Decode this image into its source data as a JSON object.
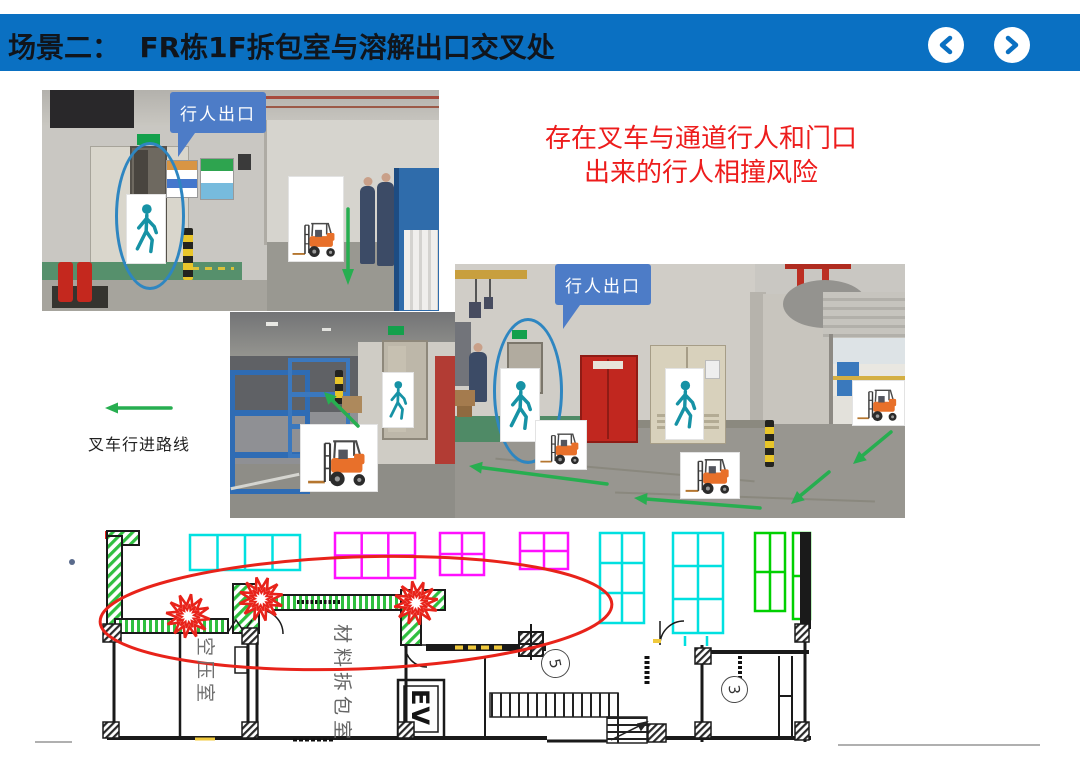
{
  "slide": {
    "title": "场景二：  FR栋1F拆包室与溶解出口交叉处",
    "title_bar_color": "#0A70C2"
  },
  "nav": {
    "prev_icon": "chevron-left",
    "next_icon": "chevron-right"
  },
  "annotations": {
    "risk_line1": "存在叉车与通道行人和门口",
    "risk_line2": "出来的行人相撞风险",
    "risk_color": "#ED1C1C",
    "callouts": [
      {
        "text": "行人出口"
      },
      {
        "text": "行人出口"
      }
    ],
    "callout_color": "#4D7CC7",
    "legend": {
      "label": "叉车行进路线",
      "arrow_color": "#27AE50"
    }
  },
  "floor_plan": {
    "rooms": [
      {
        "label": "空压室"
      },
      {
        "label": "材料拆包室"
      }
    ],
    "elevator_label": "EV",
    "zone_numbers": [
      "5",
      "3"
    ],
    "highlight_color": "#E8231A",
    "colors": {
      "wall_hatch_green": "#2FBF3F",
      "grid_cyan": "#00E0E0",
      "grid_magenta": "#FF10FF",
      "grid_blue": "#2E75E6",
      "grid_green": "#00D000"
    }
  }
}
